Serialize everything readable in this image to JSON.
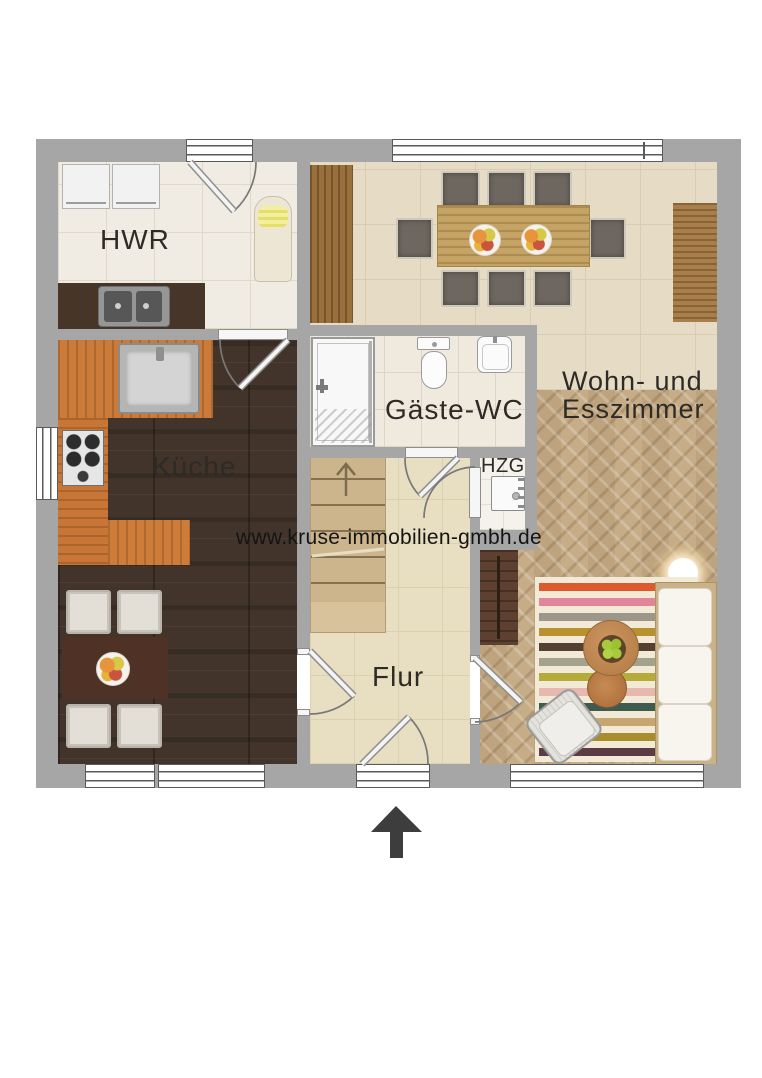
{
  "watermark": {
    "text": "www.kruse-immobilien-gmbh.de"
  },
  "rooms": {
    "hwr": {
      "label": "HWR"
    },
    "kueche": {
      "label": "Küche"
    },
    "gaeste_wc": {
      "label": "Gäste-WC"
    },
    "hzg": {
      "label": "HZG"
    },
    "flur": {
      "label": "Flur"
    },
    "wohn_esszimmer": {
      "label_line1": "Wohn- und",
      "label_line2": "Esszimmer"
    }
  },
  "compass": {
    "icon": "north-arrow-icon",
    "direction": "up"
  },
  "palette": {
    "wall_gray": "#a6a6a6",
    "hwr_tile": "#f1ece3",
    "wc_tile": "#f0eade",
    "hzg_tile": "#f4f2ea",
    "dining_tile": "#e6dcc6",
    "flur_tile": "#e8dfc2",
    "kitchen_floor_wood": "#42342a",
    "parquet_wood": "#c6ad87",
    "counter_wood": "#ca7a39",
    "stairs_wood": "#ccb58d",
    "label_text": "#2e2a26"
  },
  "living_room": {
    "rug_stripe_colors": [
      "#dd5a2f",
      "#e2849a",
      "#9d978b",
      "#b8922f",
      "#54402f",
      "#a3a28c",
      "#b5ab3b",
      "#e7b9ae",
      "#3f5a4e",
      "#c8a671",
      "#a98c2c",
      "#5d3b44"
    ]
  },
  "fixtures": {
    "hwr": [
      "washing-machine",
      "dryer",
      "ironing-board",
      "laundry-counter",
      "double-sink"
    ],
    "kueche": [
      "kitchen-counter",
      "kitchen-sink",
      "stove",
      "kitchen-table",
      "four-chairs",
      "fruit-bowl"
    ],
    "gaeste_wc": [
      "shower",
      "toilet",
      "washbasin"
    ],
    "hzg": [
      "heater"
    ],
    "flur": [
      "staircase-up"
    ],
    "wohn_esszimmer": [
      "dining-table",
      "eight-chairs",
      "two-fruit-plates",
      "sideboards",
      "rug",
      "sofa",
      "armchair",
      "coffee-table",
      "floor-lamp",
      "tv-board"
    ]
  }
}
